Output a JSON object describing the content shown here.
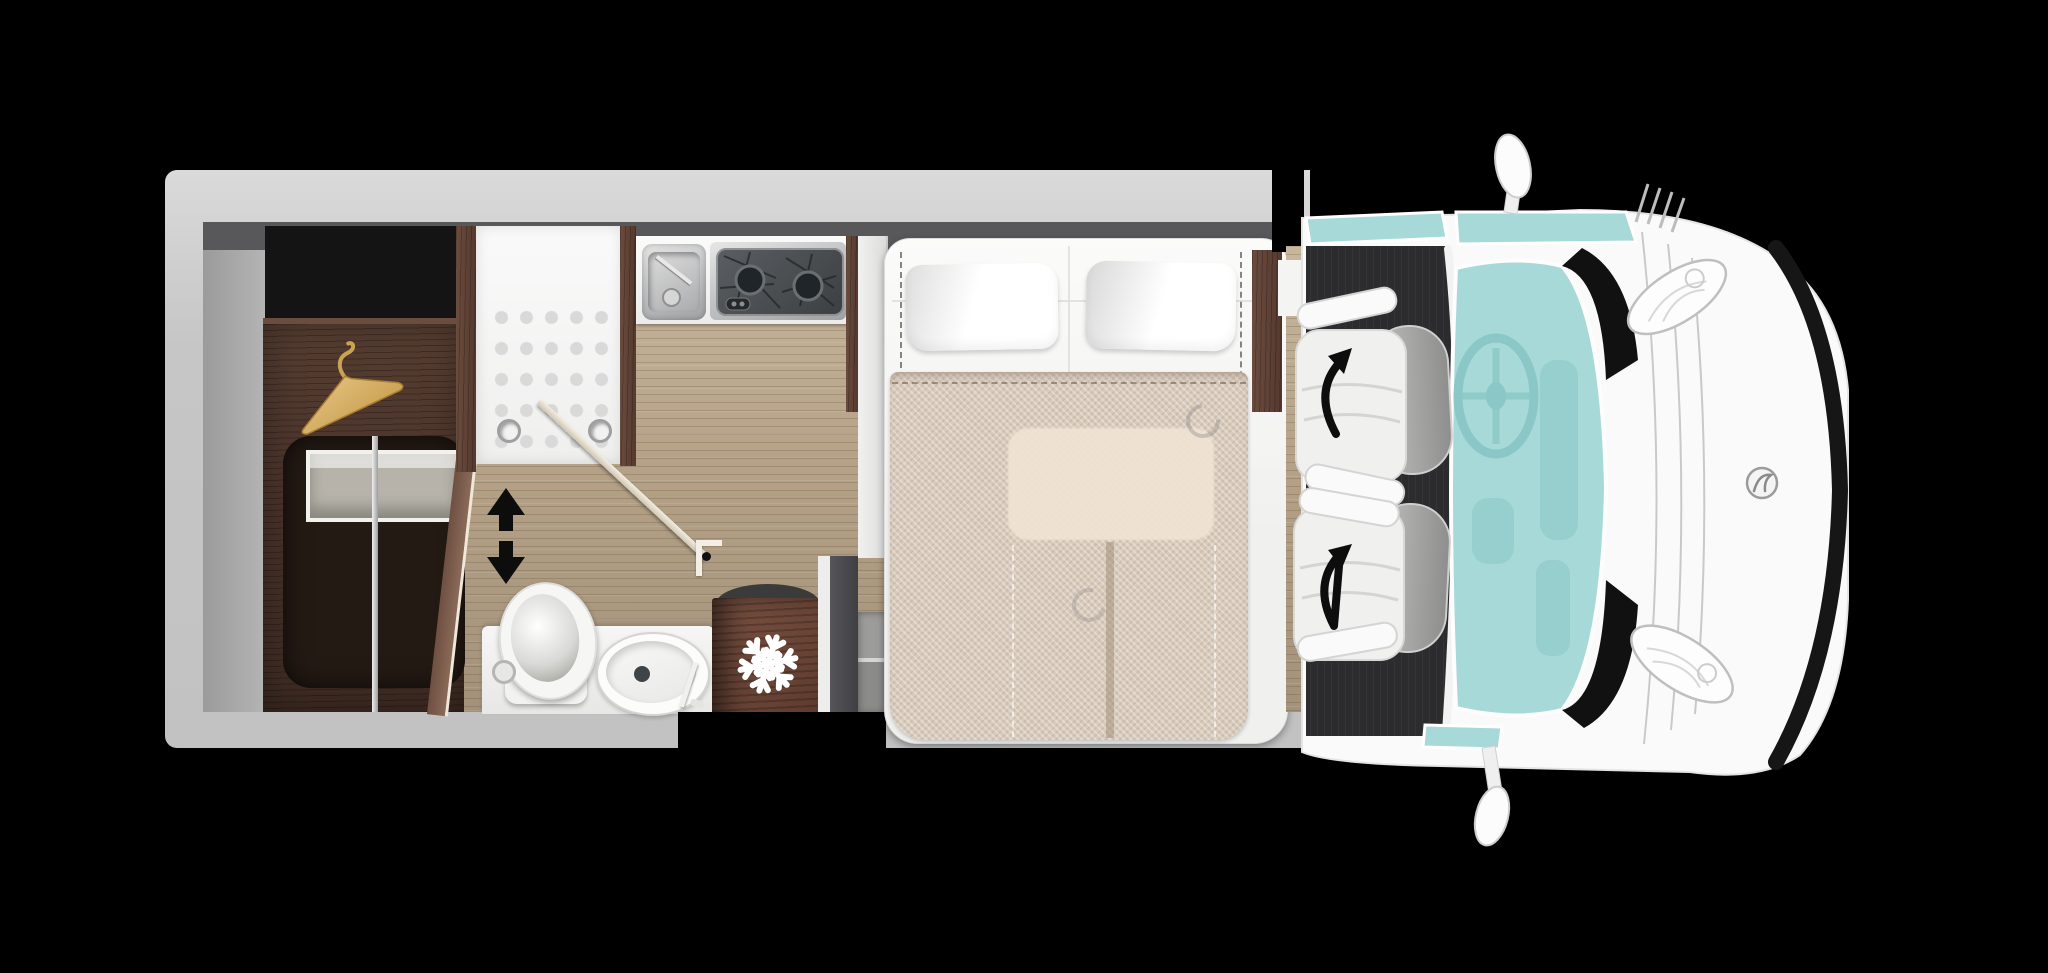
{
  "scene": {
    "type": "motorhome-floorplan",
    "view": "top-down",
    "vehicle_orientation": "cab-on-right",
    "visible_text": "none"
  },
  "palette": {
    "background": "#000000",
    "wall": "#cccccc",
    "wall_shadow": "#58585a",
    "recess_black": "#141414",
    "shower_white": "#f5f5f4",
    "shower_dot": "#d9d9d9",
    "bathroom_white": "#f1f1f0",
    "carpet": "#2c2c2e",
    "glass_teal": "#a7d9d8",
    "glass_hint": "#8ac7c6",
    "bed_white": "#f3f3f2",
    "blanket_beige": "#d9cbbc",
    "table_through": "#f0e3d4",
    "seat_white": "#f0f0ef",
    "seat_back_gray": "#a5a5a5",
    "arrow_black": "#0d0d0d",
    "hanger_gold": "#d9b36a",
    "cab_body": "#fafafa",
    "grille_black": "#161616"
  },
  "floorplan": {
    "areas": [
      {
        "name": "rear-wardrobe",
        "features": [
          "clothes-hanger",
          "tv-bracket",
          "hanging-rail"
        ]
      },
      {
        "name": "shower",
        "features": [
          "tray-dots",
          "drain",
          "drain",
          "pivot-door"
        ]
      },
      {
        "name": "kitchen",
        "features": [
          "sink-with-faucet",
          "two-burner-hob",
          "control-knob"
        ]
      },
      {
        "name": "washroom",
        "features": [
          "toilet",
          "oval-washbasin",
          "faucet",
          "sliding-door-indicator"
        ]
      },
      {
        "name": "refrigerator",
        "features": [
          "snowflake-icon"
        ]
      },
      {
        "name": "entry-step",
        "features": [
          "two-tread-step"
        ]
      },
      {
        "name": "island-bed",
        "features": [
          "pillow",
          "pillow",
          "quilt",
          "table-seen-through-dropdown-bed"
        ]
      },
      {
        "name": "cab",
        "features": [
          "swivel-seat-driver",
          "swivel-seat-passenger",
          "rotation-arrow",
          "rotation-arrow",
          "steering-wheel",
          "windshield",
          "side-mirror-top",
          "side-mirror-bottom",
          "headlight",
          "headlight",
          "brand-badge"
        ]
      }
    ],
    "indicators": {
      "sliding_door_arrow": "double-headed-vertical",
      "seat_arrows": "curved-rotation"
    },
    "counts": {
      "seats": 2,
      "pillows": 2,
      "burners": 2,
      "drains": 2,
      "mirrors": 2
    }
  }
}
